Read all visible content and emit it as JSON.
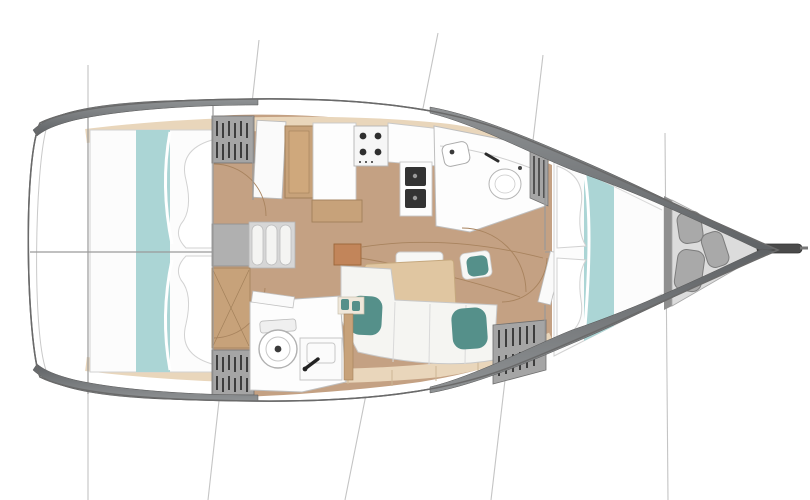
{
  "palette": {
    "hull_outline": "#6a6a6a",
    "deck_band_dark": "#5f6265",
    "deck_band_light": "#8f9294",
    "side_deck": "#e9d6bb",
    "side_deck_edge": "#cdb795",
    "floor": "#c4a183",
    "bed_white": "#fcfcfc",
    "bed_stroke": "#d2d2d2",
    "teal_light": "#abd5d5",
    "teal_dark": "#55908a",
    "wood": "#c7a27a",
    "wood_dark": "#a2805a",
    "table_wood": "#e0c6a1",
    "table_edge": "#c5a87e",
    "louver_bg": "#a5a5a5",
    "louver_slat": "#3d3d3d",
    "bow_floor": "#dcdcdc",
    "fender": "#a9a9a9",
    "fender_edge": "#7c7c7c",
    "wall_line": "#9a9a9a",
    "white_room": "#fdfdfd",
    "room_stroke": "#bfbfbf",
    "appliance_dark": "#2e2e2e",
    "arc_brown": "#a8835e",
    "rig_line": "#c4c4c4",
    "sofa_white": "#f5f5f2",
    "sofa_stroke": "#c8c8c8"
  },
  "features": [
    "hull",
    "bow-sprit",
    "bow-locker",
    "fenders",
    "forward-cabin-berth",
    "head-bathroom",
    "toilet",
    "sink",
    "galley",
    "stove",
    "galley-sinks",
    "salon-table",
    "salon-sofa",
    "sofa-cushions",
    "mast-post",
    "companionway-steps",
    "aft-cabin-berth",
    "aft-bathroom",
    "side-decks",
    "rigging-lines",
    "door-swing-arcs"
  ]
}
